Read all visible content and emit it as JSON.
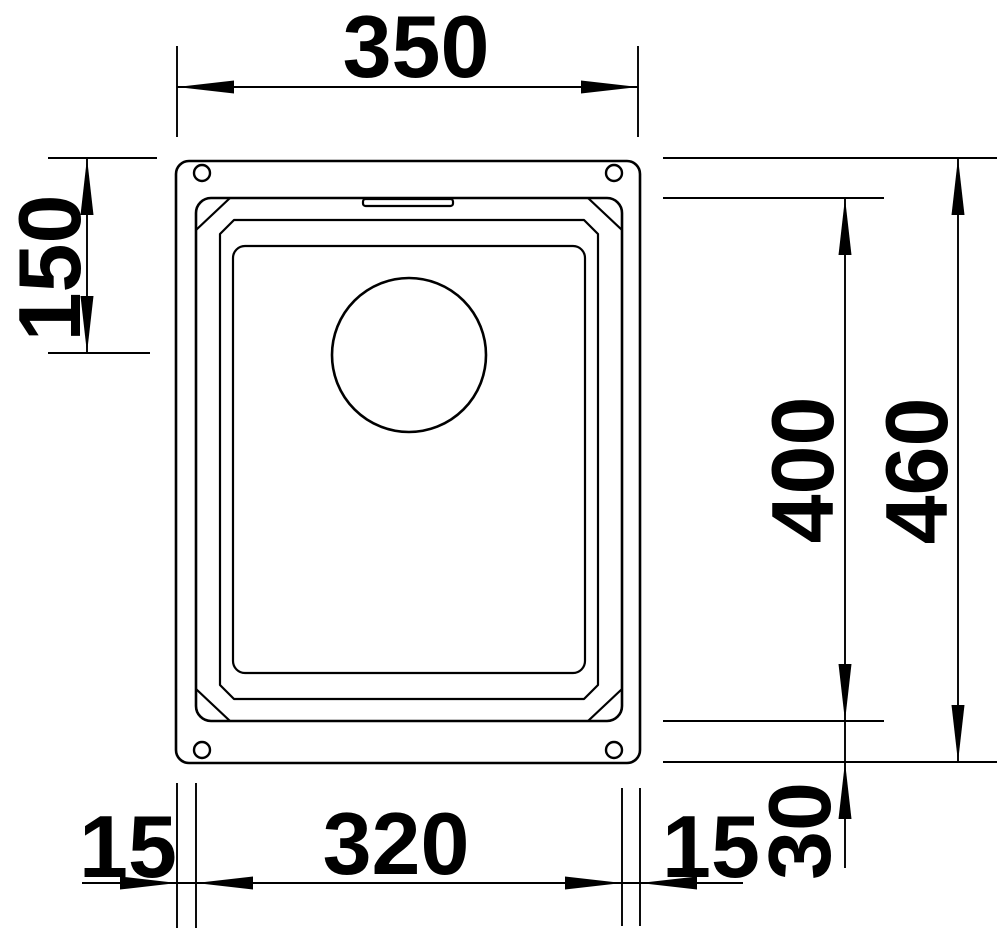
{
  "diagram": {
    "type": "technical_drawing",
    "subject": "undermount sink - top view dimension drawing",
    "dimensions": {
      "overall_width": "350",
      "top_edge_to_drain_center": "150",
      "bowl_length": "400",
      "overall_length": "460",
      "left_rim_width": "15",
      "bowl_width": "320",
      "right_rim_width": "15",
      "bottom_rim_width": "30"
    }
  }
}
